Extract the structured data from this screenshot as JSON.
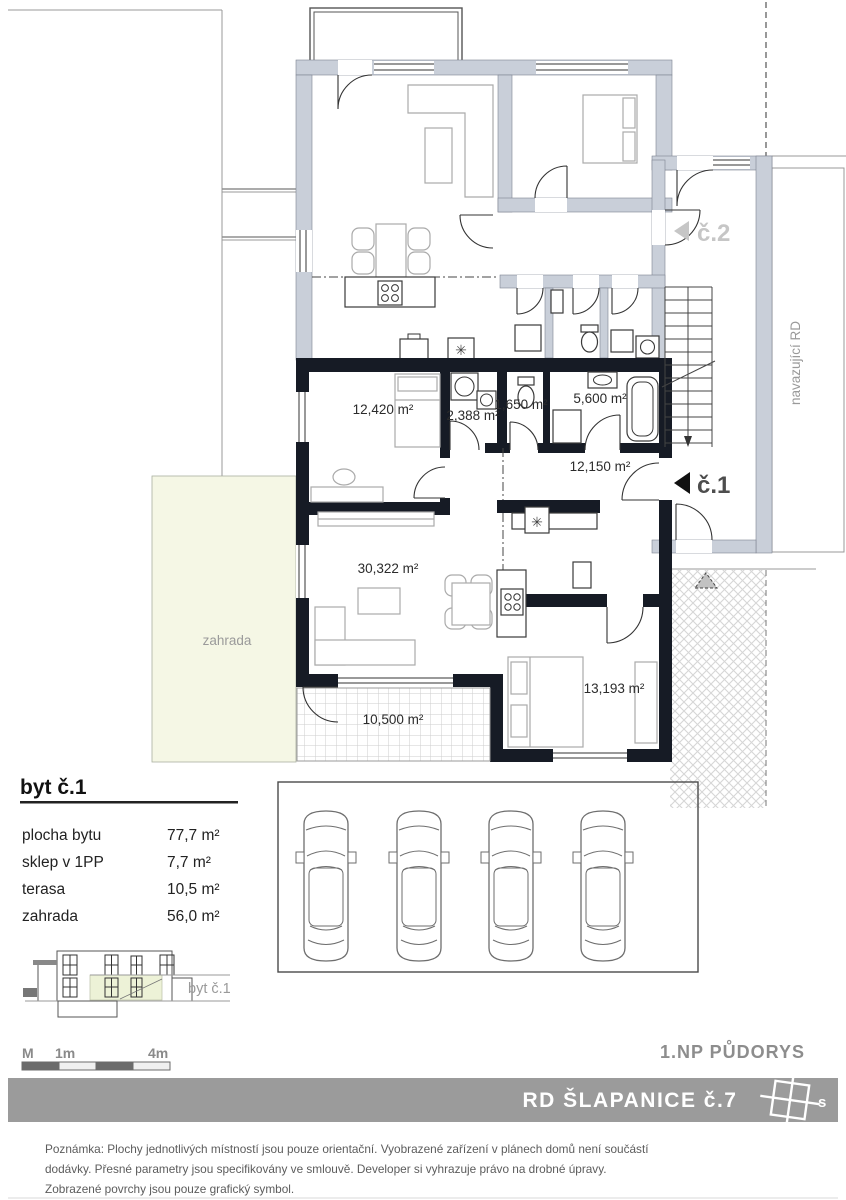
{
  "plan": {
    "garden_label": "zahrada",
    "adjacent_label": "navazující RD",
    "unit2_marker": "č.2",
    "unit1_marker": "č.1",
    "sink_symbol": "✳",
    "rooms": [
      {
        "name": "bedroom-1",
        "area": "12,420 m²"
      },
      {
        "name": "shower-room",
        "area": "2,388 m²"
      },
      {
        "name": "wc",
        "area": "1,650 m²"
      },
      {
        "name": "bathroom",
        "area": "5,600 m²"
      },
      {
        "name": "hall",
        "area": "12,150 m²"
      },
      {
        "name": "living-room",
        "area": "30,322 m²"
      },
      {
        "name": "bedroom-2",
        "area": "13,193 m²"
      },
      {
        "name": "terrace",
        "area": "10,500 m²"
      }
    ]
  },
  "legend": {
    "title": "byt č.1",
    "rows": [
      {
        "label": "plocha bytu",
        "value": "77,7  m²"
      },
      {
        "label": "sklep v 1PP",
        "value": "7,7 m²"
      },
      {
        "label": "terasa",
        "value": "10,5  m²"
      },
      {
        "label": "zahrada",
        "value": "56,0 m²"
      }
    ]
  },
  "elevation": {
    "unit_label": "byt č.1"
  },
  "scalebar": {
    "unit": "M",
    "start": "1m",
    "end": "4m"
  },
  "titles": {
    "drawing_title": "1.NP  PŮDORYS",
    "project_title": "RD ŠLAPANICE  č.7",
    "north_label": "s"
  },
  "note": {
    "line1": "Poznámka: Plochy jednotlivých místností jsou pouze orientační. Vyobrazené zařízení v plánech domů  není součástí",
    "line2": "dodávky. Přesné parametry jsou specifikovány ve smlouvě. Developer si vyhrazuje právo na drobné úpravy.",
    "line3": "Zobrazené povrchy jsou pouze grafický symbol."
  },
  "colors": {
    "unit1_wall": "#161b25",
    "unit2_wall": "#c9cfd9",
    "garden_fill": "#f5f7e5",
    "banner_fill": "#9b9b9b",
    "highlight_fill": "#edf2d7"
  }
}
